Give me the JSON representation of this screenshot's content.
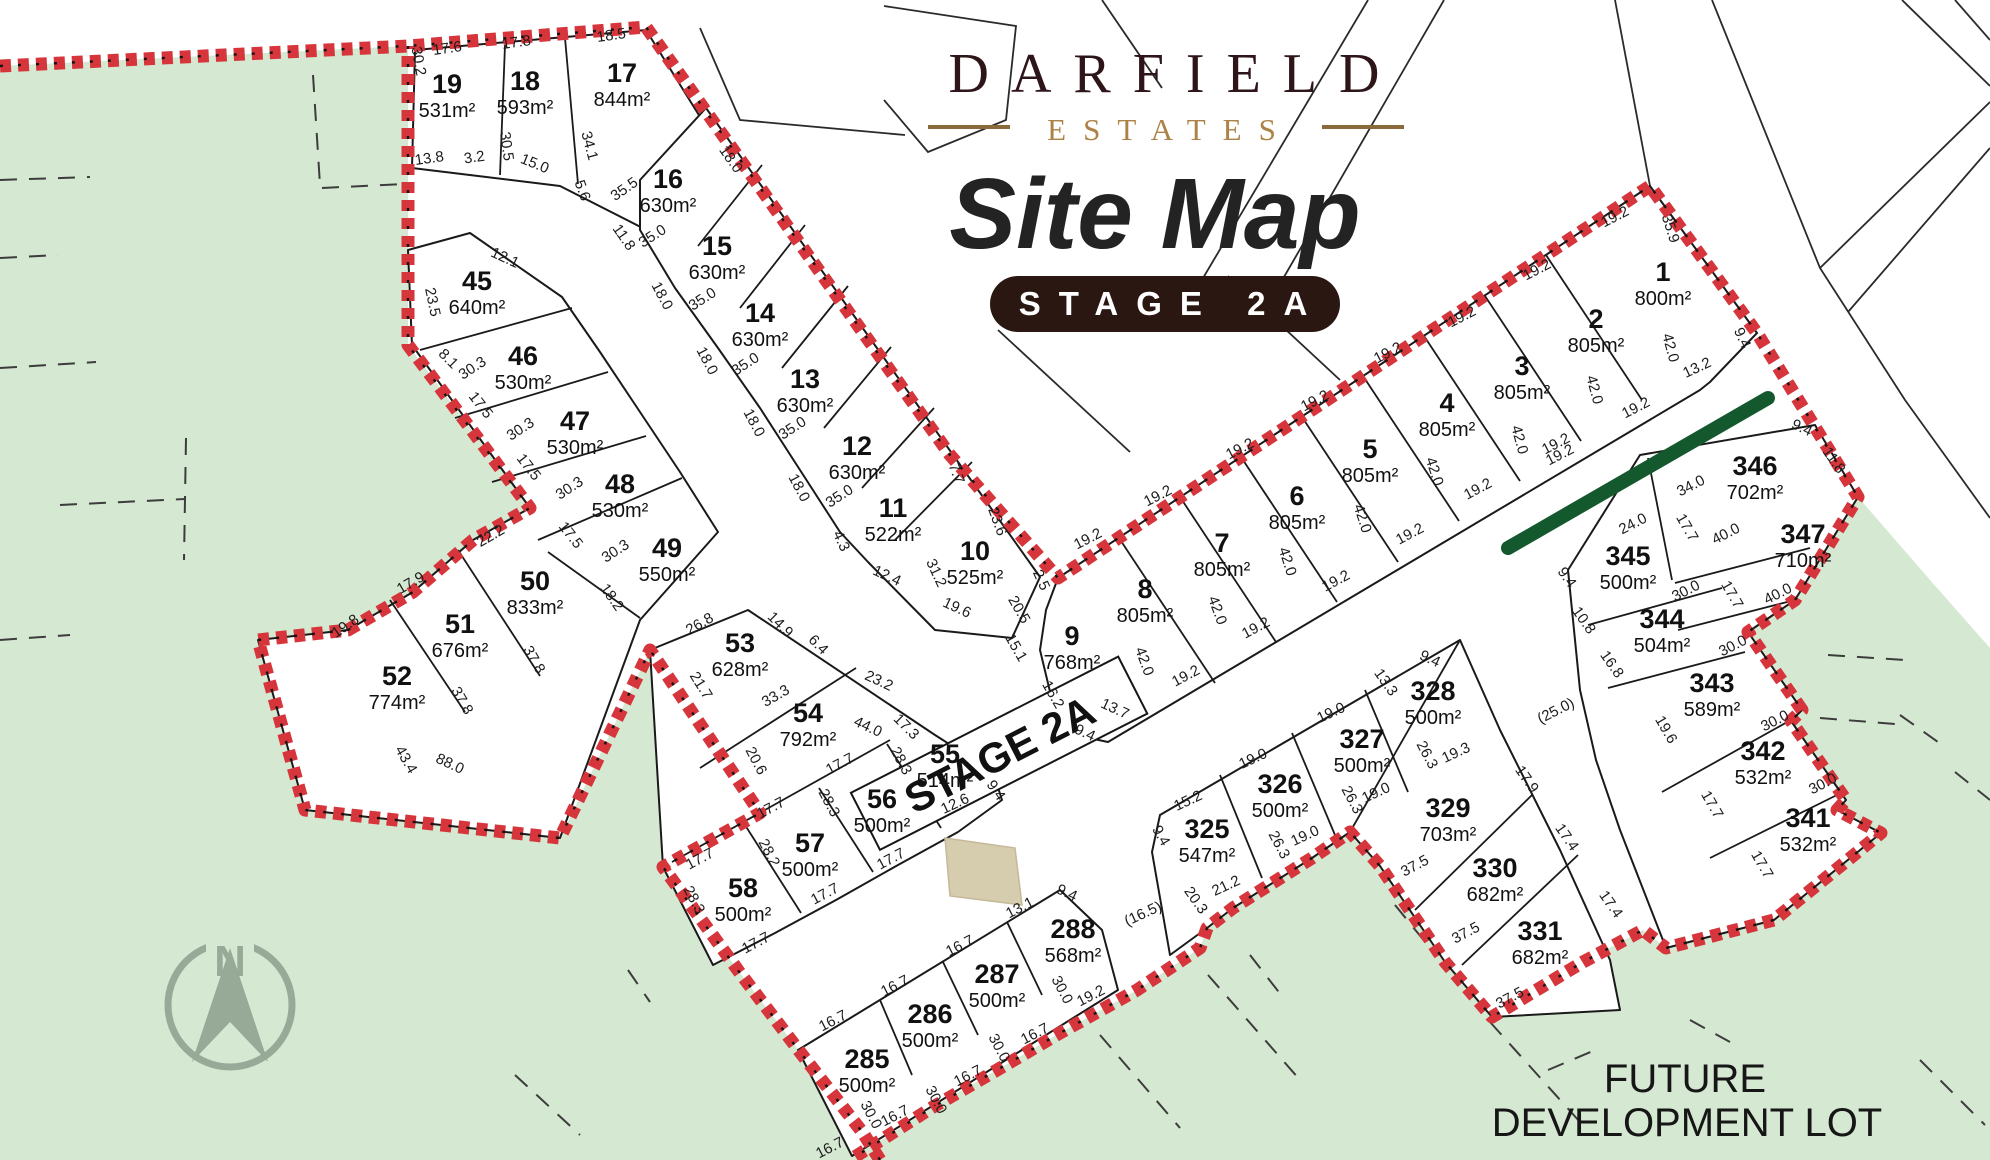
{
  "title": {
    "brand": "DARFIELD",
    "brand_sub": "ESTATES",
    "map_title": "Site Map",
    "stage_badge": "STAGE 2A"
  },
  "road_label": "STAGE 2A",
  "future_lot": {
    "line1": "FUTURE",
    "line2": "DEVELOPMENT LOT"
  },
  "compass": {
    "label": "N"
  },
  "colors": {
    "green_area": "#d5e8d1",
    "boundary_red": "#d6353c",
    "accent_dark_green": "#14592e",
    "beige_marker": "#d6ccae",
    "brand_maroon": "#2e151a",
    "brand_gold": "#ad8246",
    "badge_brown": "#2b1711"
  },
  "lots": [
    [
      "1",
      "800m²",
      1663,
      281
    ],
    [
      "2",
      "805m²",
      1596,
      328
    ],
    [
      "3",
      "805m²",
      1522,
      375
    ],
    [
      "4",
      "805m²",
      1447,
      412
    ],
    [
      "5",
      "805m²",
      1370,
      458
    ],
    [
      "6",
      "805m²",
      1297,
      505
    ],
    [
      "7",
      "805m²",
      1222,
      552
    ],
    [
      "8",
      "805m²",
      1145,
      598
    ],
    [
      "9",
      "768m²",
      1072,
      645
    ],
    [
      "10",
      "525m²",
      975,
      560
    ],
    [
      "11",
      "522m²",
      893,
      517
    ],
    [
      "12",
      "630m²",
      857,
      455
    ],
    [
      "13",
      "630m²",
      805,
      388
    ],
    [
      "14",
      "630m²",
      760,
      322
    ],
    [
      "15",
      "630m²",
      717,
      255
    ],
    [
      "16",
      "630m²",
      668,
      188
    ],
    [
      "17",
      "844m²",
      622,
      82
    ],
    [
      "18",
      "593m²",
      525,
      90
    ],
    [
      "19",
      "531m²",
      447,
      93
    ],
    [
      "45",
      "640m²",
      477,
      290
    ],
    [
      "46",
      "530m²",
      523,
      365
    ],
    [
      "47",
      "530m²",
      575,
      430
    ],
    [
      "48",
      "530m²",
      620,
      493
    ],
    [
      "49",
      "550m²",
      667,
      557
    ],
    [
      "50",
      "833m²",
      535,
      590
    ],
    [
      "51",
      "676m²",
      460,
      633
    ],
    [
      "52",
      "774m²",
      397,
      685
    ],
    [
      "53",
      "628m²",
      740,
      652
    ],
    [
      "54",
      "792m²",
      808,
      722
    ],
    [
      "55",
      "514m²",
      945,
      763
    ],
    [
      "56",
      "500m²",
      882,
      808
    ],
    [
      "57",
      "500m²",
      810,
      852
    ],
    [
      "58",
      "500m²",
      743,
      897
    ],
    [
      "285",
      "500m²",
      867,
      1068
    ],
    [
      "286",
      "500m²",
      930,
      1023
    ],
    [
      "287",
      "500m²",
      997,
      983
    ],
    [
      "288",
      "568m²",
      1073,
      938
    ],
    [
      "325",
      "547m²",
      1207,
      838
    ],
    [
      "326",
      "500m²",
      1280,
      793
    ],
    [
      "327",
      "500m²",
      1362,
      748
    ],
    [
      "328",
      "500m²",
      1433,
      700
    ],
    [
      "329",
      "703m²",
      1448,
      817
    ],
    [
      "330",
      "682m²",
      1495,
      877
    ],
    [
      "331",
      "682m²",
      1540,
      940
    ],
    [
      "341",
      "532m²",
      1808,
      827
    ],
    [
      "342",
      "532m²",
      1763,
      760
    ],
    [
      "343",
      "589m²",
      1712,
      692
    ],
    [
      "344",
      "504m²",
      1662,
      628
    ],
    [
      "345",
      "500m²",
      1628,
      565
    ],
    [
      "346",
      "702m²",
      1755,
      475
    ],
    [
      "347",
      "710m²",
      1803,
      543
    ]
  ],
  "dims": [
    [
      "30.2",
      414,
      62,
      80
    ],
    [
      "17.6",
      448,
      53,
      -8
    ],
    [
      "17.8",
      517,
      47,
      -8
    ],
    [
      "18.5",
      612,
      40,
      -8
    ],
    [
      "13.8",
      430,
      163,
      -8
    ],
    [
      "3.2",
      475,
      162,
      -8
    ],
    [
      "30.5",
      502,
      147,
      82
    ],
    [
      "15.0",
      533,
      168,
      22
    ],
    [
      "34.1",
      585,
      147,
      75
    ],
    [
      "5.6",
      578,
      192,
      70
    ],
    [
      "18.0",
      727,
      162,
      55
    ],
    [
      "35.5",
      627,
      193,
      -35
    ],
    [
      "11.8",
      620,
      240,
      55
    ],
    [
      "35.0",
      655,
      240,
      -33
    ],
    [
      "18.0",
      658,
      298,
      62
    ],
    [
      "35.0",
      705,
      303,
      -33
    ],
    [
      "18.0",
      703,
      363,
      62
    ],
    [
      "35.0",
      748,
      368,
      -33
    ],
    [
      "18.0",
      750,
      425,
      62
    ],
    [
      "35.0",
      795,
      432,
      -33
    ],
    [
      "18.0",
      795,
      490,
      62
    ],
    [
      "35.0",
      842,
      500,
      -33
    ],
    [
      "12.1",
      503,
      262,
      25
    ],
    [
      "23.5",
      428,
      303,
      78
    ],
    [
      "8.1",
      445,
      362,
      45
    ],
    [
      "30.3",
      475,
      372,
      -33
    ],
    [
      "17.5",
      477,
      408,
      52
    ],
    [
      "30.3",
      523,
      433,
      -33
    ],
    [
      "17.5",
      525,
      470,
      52
    ],
    [
      "30.3",
      572,
      492,
      -33
    ],
    [
      "17.5",
      567,
      538,
      52
    ],
    [
      "30.3",
      618,
      555,
      -33
    ],
    [
      "18.2",
      608,
      600,
      55
    ],
    [
      "22.2",
      493,
      540,
      -30
    ],
    [
      "17.9",
      413,
      587,
      -30
    ],
    [
      "19.8",
      348,
      630,
      -35
    ],
    [
      "37.8",
      530,
      662,
      60
    ],
    [
      "37.8",
      458,
      703,
      60
    ],
    [
      "43.4",
      402,
      762,
      60
    ],
    [
      "88.0",
      448,
      768,
      25
    ],
    [
      "26.8",
      702,
      628,
      -30
    ],
    [
      "21.7",
      697,
      688,
      58
    ],
    [
      "14.9",
      777,
      628,
      45
    ],
    [
      "6.4",
      815,
      648,
      45
    ],
    [
      "23.2",
      877,
      685,
      25
    ],
    [
      "33.3",
      778,
      700,
      -30
    ],
    [
      "44.0",
      866,
      731,
      25
    ],
    [
      "17.3",
      903,
      730,
      45
    ],
    [
      "20.6",
      752,
      763,
      62
    ],
    [
      "17.7",
      842,
      768,
      -28
    ],
    [
      "28.3",
      897,
      763,
      62
    ],
    [
      "12.6",
      957,
      808,
      -25
    ],
    [
      "9.4",
      992,
      793,
      55
    ],
    [
      "28.3",
      825,
      805,
      62
    ],
    [
      "17.7",
      773,
      812,
      -28
    ],
    [
      "28.2",
      765,
      855,
      62
    ],
    [
      "17.7",
      702,
      863,
      -28
    ],
    [
      "17.7",
      893,
      863,
      -28
    ],
    [
      "28.3",
      690,
      902,
      62
    ],
    [
      "17.7",
      758,
      947,
      -28
    ],
    [
      "17.7",
      827,
      898,
      -28
    ],
    [
      "4.3",
      837,
      543,
      65
    ],
    [
      "12.4",
      885,
      580,
      25
    ],
    [
      "31.2",
      932,
      575,
      65
    ],
    [
      "19.6",
      955,
      612,
      25
    ],
    [
      "7.7",
      952,
      475,
      70
    ],
    [
      "23.6",
      993,
      523,
      70
    ],
    [
      "2.5",
      1037,
      582,
      65
    ],
    [
      "20.5",
      1015,
      612,
      60
    ],
    [
      "15.1",
      1012,
      650,
      60
    ],
    [
      "16.2",
      1049,
      697,
      60
    ],
    [
      "9.4",
      1083,
      737,
      25
    ],
    [
      "13.7",
      1113,
      713,
      25
    ],
    [
      "42.0",
      1140,
      663,
      70
    ],
    [
      "19.2",
      1188,
      680,
      -28
    ],
    [
      "42.0",
      1213,
      612,
      70
    ],
    [
      "19.2",
      1258,
      632,
      -28
    ],
    [
      "42.0",
      1283,
      563,
      72
    ],
    [
      "19.2",
      1338,
      585,
      -28
    ],
    [
      "42.0",
      1358,
      520,
      72
    ],
    [
      "19.2",
      1412,
      538,
      -28
    ],
    [
      "42.0",
      1430,
      473,
      72
    ],
    [
      "19.2",
      1480,
      493,
      -28
    ],
    [
      "42.0",
      1515,
      441,
      75
    ],
    [
      "19.2",
      1562,
      459,
      -27
    ],
    [
      "42.0",
      1590,
      391,
      75
    ],
    [
      "19.2",
      1638,
      412,
      -27
    ],
    [
      "42.0",
      1666,
      349,
      75
    ],
    [
      "13.2",
      1699,
      372,
      -25
    ],
    [
      "9.4",
      1738,
      340,
      65
    ],
    [
      "35.9",
      1666,
      230,
      72
    ],
    [
      "19.2",
      1617,
      221,
      -27
    ],
    [
      "19.2",
      1539,
      274,
      -27
    ],
    [
      "19.2",
      1464,
      321,
      -27
    ],
    [
      "19.2",
      1390,
      357,
      -27
    ],
    [
      "19.2",
      1317,
      405,
      -27
    ],
    [
      "19.2",
      1242,
      453,
      -27
    ],
    [
      "19.2",
      1160,
      500,
      -27
    ],
    [
      "19.2",
      1090,
      543,
      -27
    ],
    [
      "9.4",
      1157,
      838,
      60
    ],
    [
      "15.2",
      1190,
      805,
      -25
    ],
    [
      "20.3",
      1192,
      903,
      55
    ],
    [
      "21.2",
      1228,
      890,
      -25
    ],
    [
      "(16.5)",
      1145,
      918,
      -25
    ],
    [
      "19.0",
      1255,
      763,
      -25
    ],
    [
      "26.3",
      1275,
      847,
      62
    ],
    [
      "19.0",
      1307,
      840,
      -25
    ],
    [
      "19.0",
      1333,
      717,
      -25
    ],
    [
      "26.3",
      1348,
      802,
      62
    ],
    [
      "19.0",
      1378,
      797,
      -25
    ],
    [
      "13.3",
      1382,
      685,
      55
    ],
    [
      "9.4",
      1428,
      663,
      25
    ],
    [
      "26.3",
      1423,
      757,
      62
    ],
    [
      "19.3",
      1458,
      757,
      -25
    ],
    [
      "17.9",
      1523,
      782,
      55
    ],
    [
      "37.5",
      1417,
      870,
      -28
    ],
    [
      "37.5",
      1468,
      937,
      -28
    ],
    [
      "37.5",
      1512,
      1002,
      -28
    ],
    [
      "17.4",
      1563,
      840,
      55
    ],
    [
      "17.4",
      1607,
      907,
      55
    ],
    [
      "16.7",
      835,
      1025,
      -27
    ],
    [
      "16.7",
      897,
      990,
      -27
    ],
    [
      "16.7",
      962,
      950,
      -27
    ],
    [
      "13.1",
      1022,
      912,
      -27
    ],
    [
      "9.4",
      1065,
      897,
      25
    ],
    [
      "30.0",
      1058,
      992,
      62
    ],
    [
      "19.2",
      1093,
      1000,
      -27
    ],
    [
      "16.7",
      1037,
      1038,
      -27
    ],
    [
      "30.0",
      995,
      1050,
      62
    ],
    [
      "16.7",
      970,
      1080,
      -27
    ],
    [
      "30.0",
      932,
      1102,
      62
    ],
    [
      "16.7",
      897,
      1120,
      -27
    ],
    [
      "30.0",
      867,
      1117,
      62
    ],
    [
      "16.7",
      832,
      1152,
      -27
    ],
    [
      "19.2",
      1558,
      448,
      -27
    ],
    [
      "34.0",
      1693,
      490,
      -27
    ],
    [
      "24.0",
      1635,
      528,
      -27
    ],
    [
      "17.7",
      1683,
      530,
      60
    ],
    [
      "40.0",
      1728,
      538,
      -27
    ],
    [
      "9.4",
      1800,
      432,
      25
    ],
    [
      "11.8",
      1830,
      463,
      55
    ],
    [
      "9.4",
      1563,
      580,
      55
    ],
    [
      "30.0",
      1688,
      595,
      -27
    ],
    [
      "17.7",
      1728,
      597,
      60
    ],
    [
      "40.0",
      1780,
      598,
      -27
    ],
    [
      "10.8",
      1580,
      623,
      55
    ],
    [
      "16.8",
      1608,
      667,
      55
    ],
    [
      "30.0",
      1735,
      650,
      -27
    ],
    [
      "19.6",
      1662,
      732,
      60
    ],
    [
      "(25.0)",
      1558,
      715,
      -27
    ],
    [
      "30.0",
      1777,
      725,
      -27
    ],
    [
      "17.7",
      1708,
      807,
      60
    ],
    [
      "30.0",
      1825,
      788,
      -27
    ],
    [
      "17.7",
      1758,
      867,
      60
    ]
  ]
}
